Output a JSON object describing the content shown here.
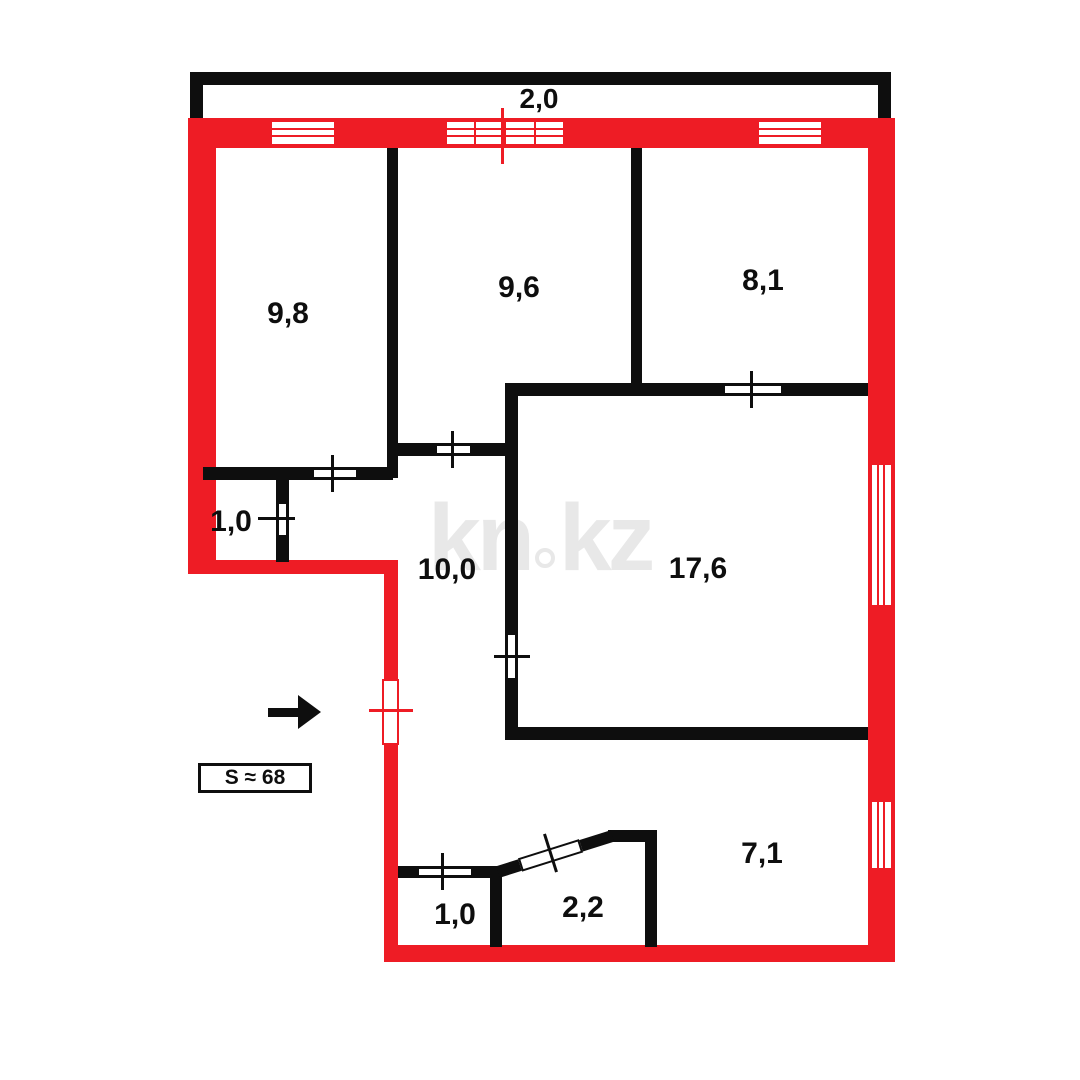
{
  "colors": {
    "red": "#ee1c25",
    "black": "#0e0e0e",
    "watermark_gray": "#e8e8e8",
    "background": "#ffffff"
  },
  "balcony": {
    "label": "2,0"
  },
  "rooms": [
    {
      "id": "room-9-8",
      "label": "9,8"
    },
    {
      "id": "room-9-6",
      "label": "9,6"
    },
    {
      "id": "room-8-1",
      "label": "8,1"
    },
    {
      "id": "closet-1-0-left",
      "label": "1,0"
    },
    {
      "id": "hall-10-0",
      "label": "10,0"
    },
    {
      "id": "room-17-6",
      "label": "17,6"
    },
    {
      "id": "wc-1-0-bottom",
      "label": "1,0"
    },
    {
      "id": "bath-2-2",
      "label": "2,2"
    },
    {
      "id": "hall-7-1",
      "label": "7,1"
    }
  ],
  "area_badge": {
    "label": "S ≈ 68"
  },
  "watermark": {
    "left": "kn",
    "right": "kz"
  },
  "geometry": {
    "red_walls": [
      {
        "name": "outer-wall-top",
        "x": 188,
        "y": 118,
        "w": 707,
        "h": 30
      },
      {
        "name": "outer-wall-left",
        "x": 188,
        "y": 118,
        "w": 28,
        "h": 456
      },
      {
        "name": "outer-wall-step",
        "x": 188,
        "y": 560,
        "w": 210,
        "h": 14
      },
      {
        "name": "outer-wall-entry-side",
        "x": 384,
        "y": 560,
        "w": 14,
        "h": 402
      },
      {
        "name": "outer-wall-bottom",
        "x": 384,
        "y": 945,
        "w": 511,
        "h": 17
      },
      {
        "name": "outer-wall-right",
        "x": 868,
        "y": 118,
        "w": 27,
        "h": 844
      }
    ],
    "black_walls": [
      {
        "name": "wall-9-8-9-6",
        "x": 387,
        "y": 148,
        "w": 11,
        "h": 330
      },
      {
        "name": "wall-9-6-8-1",
        "x": 631,
        "y": 148,
        "w": 11,
        "h": 242
      },
      {
        "name": "wall-17-6-top",
        "x": 510,
        "y": 383,
        "w": 358,
        "h": 13
      },
      {
        "name": "wall-17-6-left",
        "x": 505,
        "y": 383,
        "w": 13,
        "h": 355
      },
      {
        "name": "wall-17-6-bottom",
        "x": 505,
        "y": 727,
        "w": 363,
        "h": 13
      },
      {
        "name": "wall-9-6-bottom",
        "x": 392,
        "y": 443,
        "w": 118,
        "h": 13
      },
      {
        "name": "wall-9-8-bottom",
        "x": 203,
        "y": 467,
        "w": 190,
        "h": 13
      },
      {
        "name": "wall-closet-1-0-right",
        "x": 276,
        "y": 467,
        "w": 13,
        "h": 95
      },
      {
        "name": "wall-wc-1-0-top",
        "x": 398,
        "y": 866,
        "w": 104,
        "h": 12
      },
      {
        "name": "wall-wc-1-0-right",
        "x": 490,
        "y": 866,
        "w": 12,
        "h": 81
      },
      {
        "name": "wall-bath-2-2-top",
        "x": 608,
        "y": 830,
        "w": 49,
        "h": 12
      },
      {
        "name": "wall-bath-2-2-right",
        "x": 645,
        "y": 830,
        "w": 12,
        "h": 117
      },
      {
        "name": "wall-bath-2-2-diagonal",
        "x": 498,
        "y": 866,
        "w": 120,
        "h": 12,
        "rotate": -17.5,
        "origin": "0 50%"
      }
    ],
    "windows": [
      {
        "name": "window-room-9-8",
        "x": 270,
        "y": 120,
        "w": 66,
        "h": 26,
        "hlines": [
          6,
          13
        ],
        "vlines": []
      },
      {
        "name": "window-balcony-door",
        "x": 445,
        "y": 120,
        "w": 120,
        "h": 26,
        "hlines": [
          6,
          13
        ],
        "vlines": [
          27,
          57,
          87
        ]
      },
      {
        "name": "window-room-8-1",
        "x": 757,
        "y": 120,
        "w": 66,
        "h": 26,
        "hlines": [
          6,
          13
        ],
        "vlines": []
      },
      {
        "name": "window-room-17-6",
        "x": 870,
        "y": 463,
        "w": 23,
        "h": 144,
        "hlines": [],
        "vlines": [
          5,
          11
        ]
      },
      {
        "name": "window-hall-7-1",
        "x": 870,
        "y": 800,
        "w": 23,
        "h": 70,
        "hlines": [],
        "vlines": [
          5,
          11
        ]
      }
    ],
    "doors": [
      {
        "name": "door-room-8-1",
        "x": 723,
        "y": 384,
        "w": 60,
        "h": 11,
        "style": "black"
      },
      {
        "name": "door-room-9-6",
        "x": 435,
        "y": 444,
        "w": 37,
        "h": 11,
        "style": "black"
      },
      {
        "name": "door-room-9-8",
        "x": 312,
        "y": 468,
        "w": 46,
        "h": 11,
        "style": "black"
      },
      {
        "name": "door-closet-1-0",
        "x": 277,
        "y": 502,
        "w": 11,
        "h": 35,
        "style": "black"
      },
      {
        "name": "door-room-17-6",
        "x": 506,
        "y": 633,
        "w": 11,
        "h": 47,
        "style": "black"
      },
      {
        "name": "door-wc-1-0",
        "x": 417,
        "y": 867,
        "w": 56,
        "h": 10,
        "style": "black"
      },
      {
        "name": "door-bath-2-2",
        "x": 520,
        "y": 858,
        "w": 64,
        "h": 14,
        "style": "black",
        "rotate": -17.5,
        "origin": "0 50%"
      },
      {
        "name": "door-entry",
        "x": 382,
        "y": 679,
        "w": 17,
        "h": 66,
        "style": "red"
      }
    ],
    "ticks": [
      {
        "name": "tick-door-8-1",
        "x": 750,
        "y": 371,
        "w": 3,
        "h": 37,
        "color": "black"
      },
      {
        "name": "tick-door-9-6",
        "x": 451,
        "y": 431,
        "w": 3,
        "h": 37,
        "color": "black"
      },
      {
        "name": "tick-door-9-8",
        "x": 331,
        "y": 455,
        "w": 3,
        "h": 37,
        "color": "black"
      },
      {
        "name": "tick-door-closet",
        "x": 258,
        "y": 517,
        "w": 37,
        "h": 3,
        "color": "black"
      },
      {
        "name": "tick-door-17-6",
        "x": 494,
        "y": 655,
        "w": 36,
        "h": 3,
        "color": "black"
      },
      {
        "name": "tick-door-wc",
        "x": 441,
        "y": 853,
        "w": 3,
        "h": 37,
        "color": "black"
      },
      {
        "name": "tick-door-bath",
        "x": 549,
        "y": 833,
        "w": 3,
        "h": 40,
        "color": "black",
        "rotate": -17.5
      },
      {
        "name": "tick-door-entry",
        "x": 369,
        "y": 709,
        "w": 44,
        "h": 3,
        "color": "red"
      },
      {
        "name": "tick-balcony-center",
        "x": 501,
        "y": 108,
        "w": 3,
        "h": 56,
        "color": "red"
      }
    ]
  }
}
